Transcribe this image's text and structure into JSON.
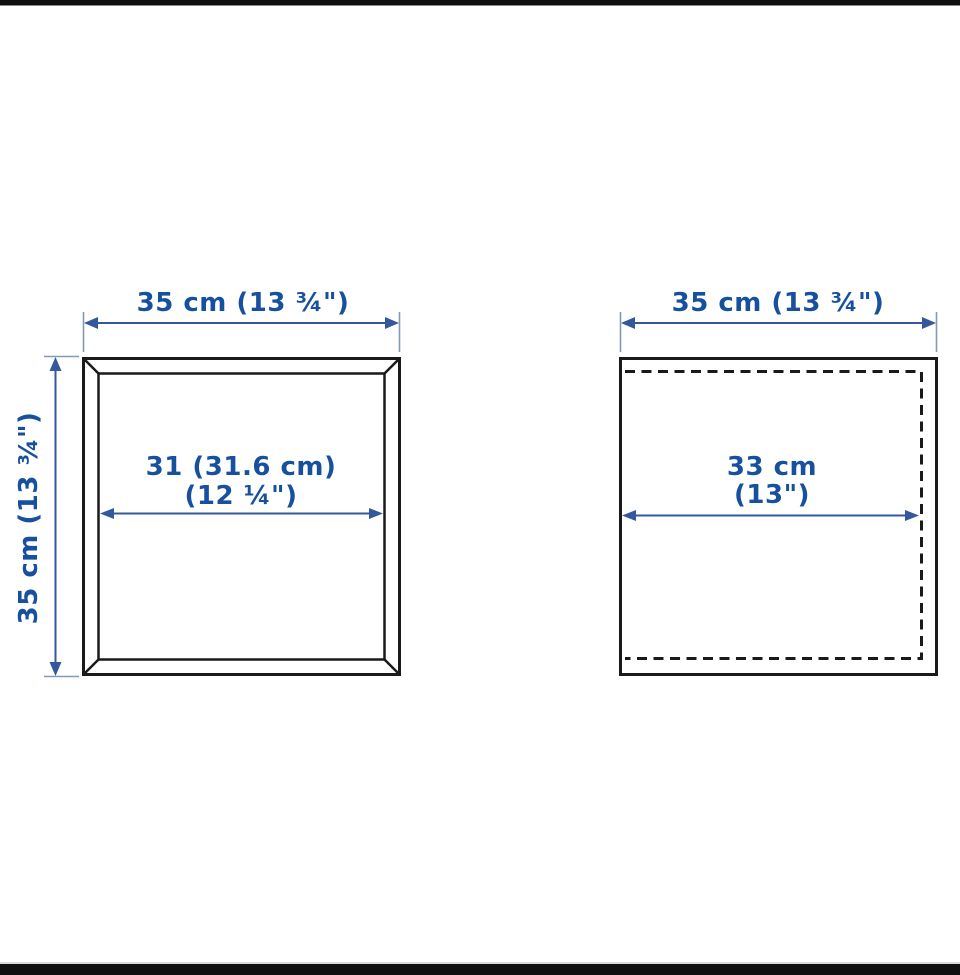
{
  "diagram": {
    "title": "cabinet-dimension-drawing",
    "colors": {
      "dimension_text": "#17509e",
      "arrow": "#33589b",
      "extension_line": "#8099bd",
      "outline": "#1a1a1a",
      "letterbox": "#0f0f0f",
      "background": "#ffffff"
    },
    "left_view": {
      "top_width_label": "35 cm (13 ¾\")",
      "side_height_label": "35 cm (13 ¾\")",
      "inner_width_line1": "31 (31.6 cm)",
      "inner_width_line2": "(12 ¼\")"
    },
    "right_view": {
      "top_width_label": "35 cm (13 ¾\")",
      "inner_width_line1": "33 cm",
      "inner_width_line2": "(13\")"
    }
  }
}
